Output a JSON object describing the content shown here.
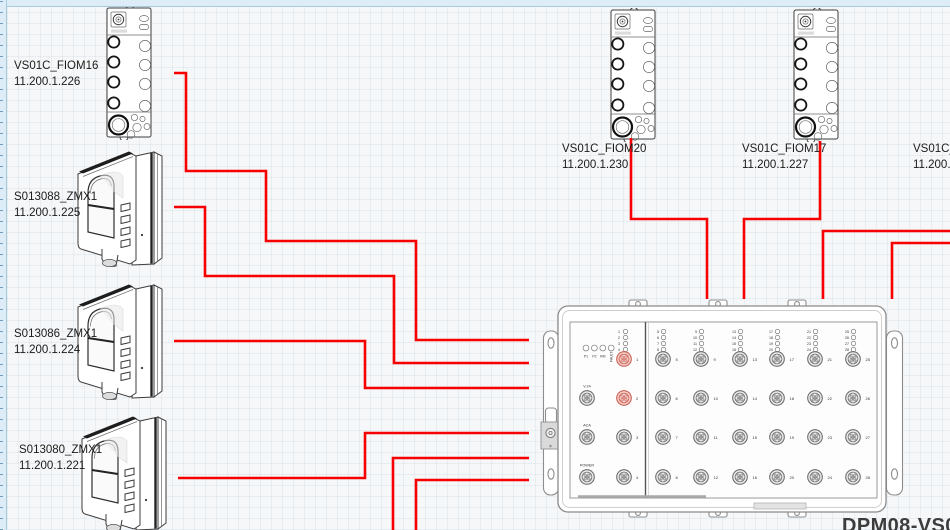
{
  "app": {
    "background": "#f6f7f8",
    "wire_color": "#f80000",
    "highlight_port_stroke": "#c96055",
    "highlight_port_fill": "#f6d0c9"
  },
  "devices": {
    "fiom16": {
      "name": "VS01C_FIOM16",
      "ip": "11.200.1.226"
    },
    "camera_225": {
      "name": "S013088_ZMX1",
      "ip": "11.200.1.225"
    },
    "camera_224": {
      "name": "S013086_ZMX1",
      "ip": "11.200.1.224"
    },
    "camera_221": {
      "name": "S013080_ZMX1",
      "ip": "11.200.1.221"
    },
    "fiom20": {
      "name": "VS01C_FIOM20",
      "ip": "11.200.1.230"
    },
    "fiom17": {
      "name": "VS01C_FIOM17",
      "ip": "11.200.1.227"
    },
    "fiom_offscreen": {
      "name": "VS01C_F",
      "ip": "11.200.1"
    }
  },
  "switch": {
    "model_label": "DPM08-VS0",
    "status_leds": [
      "P1",
      "P2",
      "RM",
      "FAULT"
    ],
    "left_led_numbers": [
      "1",
      "2",
      "3",
      "4"
    ],
    "left_port_labels": [
      "V.24",
      "ACA",
      "POWER"
    ],
    "numbered_ports": [
      "1",
      "2",
      "3",
      "4"
    ],
    "highlighted_ports": [
      "1",
      "2"
    ],
    "port_columns": [
      [
        "5",
        "6",
        "7",
        "8"
      ],
      [
        "9",
        "10",
        "11",
        "12"
      ],
      [
        "13",
        "14",
        "15",
        "16"
      ],
      [
        "17",
        "18",
        "19",
        "20"
      ],
      [
        "21",
        "22",
        "23",
        "24"
      ],
      [
        "25",
        "26",
        "27",
        "28"
      ]
    ]
  },
  "connections": [
    {
      "from": "fiom16",
      "to": "switch",
      "points": [
        [
          174,
          73
        ],
        [
          186,
          73
        ],
        [
          186,
          171
        ],
        [
          266,
          171
        ],
        [
          266,
          241
        ],
        [
          416,
          241
        ],
        [
          416,
          340
        ],
        [
          529,
          340
        ]
      ]
    },
    {
      "from": "camera_225",
      "to": "switch",
      "points": [
        [
          174,
          207
        ],
        [
          205,
          207
        ],
        [
          205,
          276
        ],
        [
          394,
          276
        ],
        [
          394,
          363
        ],
        [
          529,
          363
        ]
      ]
    },
    {
      "from": "camera_224",
      "to": "switch",
      "points": [
        [
          174,
          341
        ],
        [
          365,
          341
        ],
        [
          365,
          388
        ],
        [
          529,
          388
        ]
      ]
    },
    {
      "from": "camera_221",
      "to": "switch",
      "points": [
        [
          178,
          478
        ],
        [
          365,
          478
        ],
        [
          365,
          433
        ],
        [
          529,
          433
        ]
      ]
    },
    {
      "from": "offscreen-bottom-1",
      "to": "switch",
      "points": [
        [
          393,
          531
        ],
        [
          393,
          458
        ],
        [
          529,
          458
        ]
      ]
    },
    {
      "from": "offscreen-bottom-2",
      "to": "switch",
      "points": [
        [
          416,
          531
        ],
        [
          416,
          480
        ],
        [
          529,
          480
        ]
      ]
    },
    {
      "from": "fiom20",
      "to": "switch",
      "points": [
        [
          631,
          138
        ],
        [
          631,
          219
        ],
        [
          707,
          219
        ],
        [
          707,
          299
        ]
      ]
    },
    {
      "from": "fiom17",
      "to": "switch",
      "points": [
        [
          820,
          141
        ],
        [
          820,
          219
        ],
        [
          744,
          219
        ],
        [
          744,
          299
        ]
      ]
    },
    {
      "from": "fiom_offscreen",
      "to": "switch",
      "points": [
        [
          951,
          231
        ],
        [
          823,
          231
        ],
        [
          823,
          299
        ]
      ]
    },
    {
      "from": "offscreen-right-2",
      "to": "switch",
      "points": [
        [
          951,
          243
        ],
        [
          892,
          243
        ],
        [
          892,
          299
        ]
      ]
    }
  ]
}
